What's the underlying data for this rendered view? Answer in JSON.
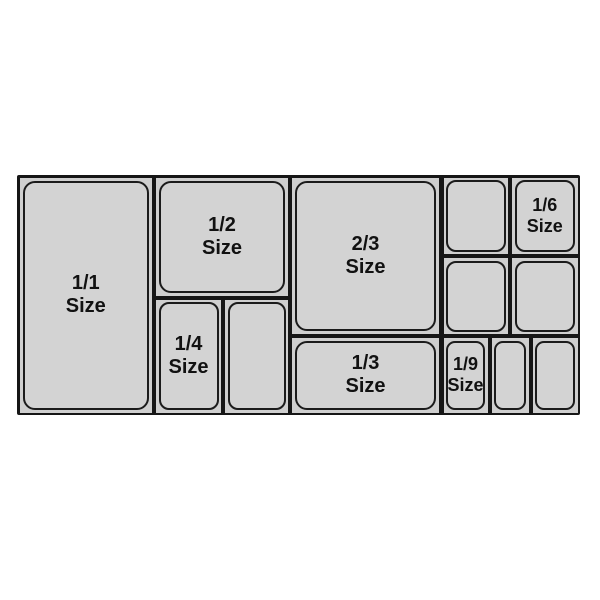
{
  "diagram": {
    "name": "food-pan-size-chart",
    "pans": {
      "full": {
        "fraction": "1/1",
        "unit": "Size"
      },
      "half": {
        "fraction": "1/2",
        "unit": "Size"
      },
      "two_thirds": {
        "fraction": "2/3",
        "unit": "Size"
      },
      "third": {
        "fraction": "1/3",
        "unit": "Size"
      },
      "quarter": {
        "fraction": "1/4",
        "unit": "Size"
      },
      "sixth": {
        "fraction": "1/6",
        "unit": "Size"
      },
      "ninth": {
        "fraction": "1/9",
        "unit": "Size"
      }
    },
    "colors": {
      "background": "#ffffff",
      "frame": "#161616",
      "cell_fill": "#cfcfcf",
      "pan_fill": "#d3d3d3",
      "outline": "#1b1b1b",
      "text": "#111111"
    }
  }
}
